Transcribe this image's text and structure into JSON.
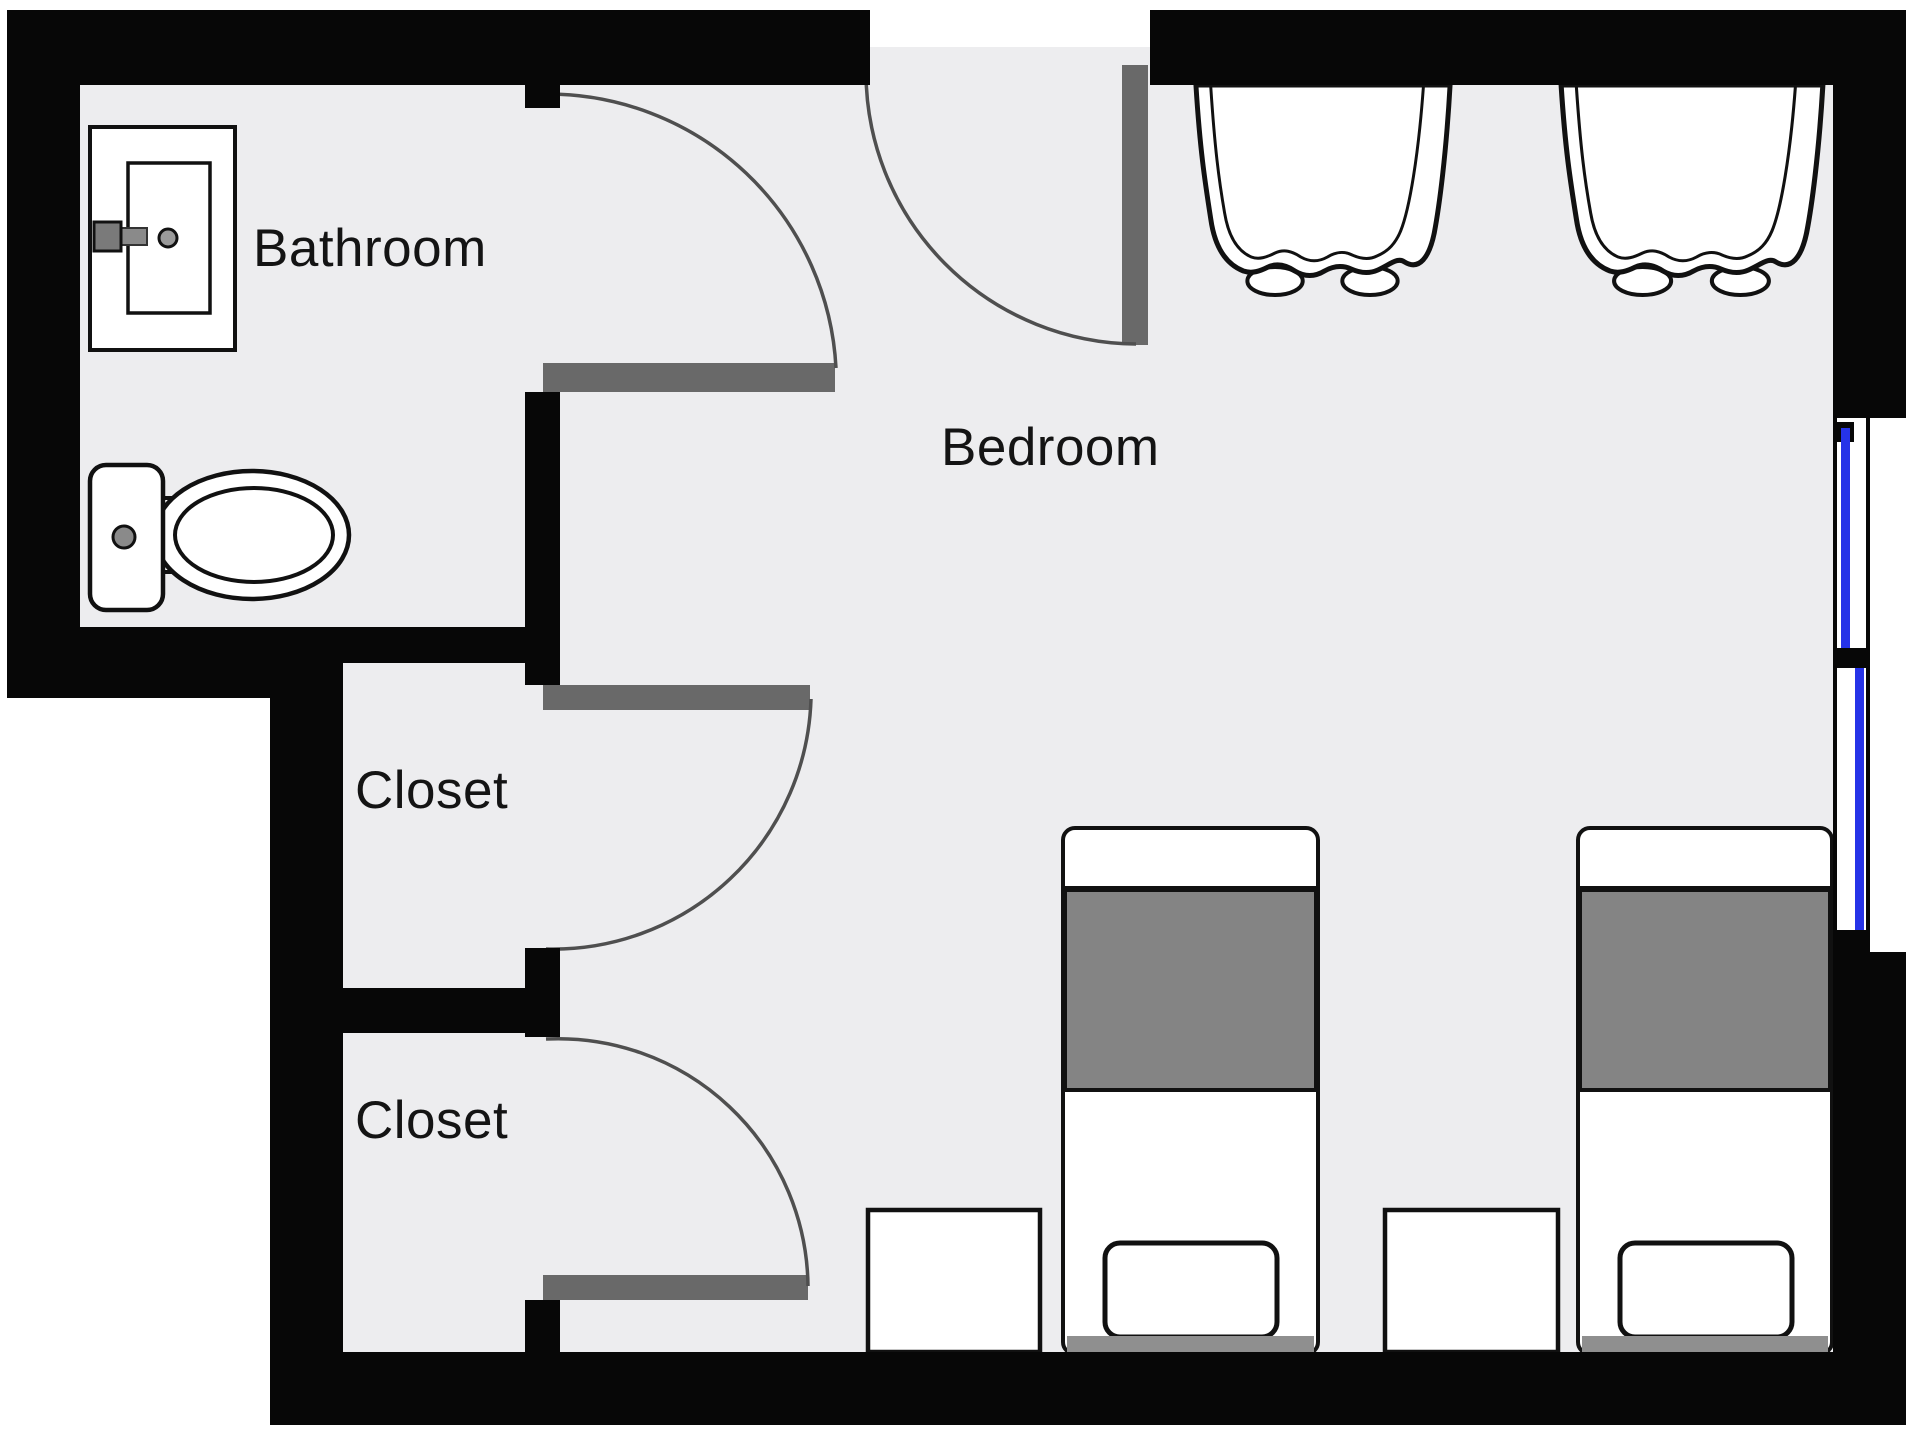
{
  "plan": {
    "rooms": [
      {
        "id": "bathroom",
        "label": "Bathroom"
      },
      {
        "id": "bedroom",
        "label": "Bedroom"
      },
      {
        "id": "closet-upper",
        "label": "Closet"
      },
      {
        "id": "closet-lower",
        "label": "Closet"
      }
    ],
    "fixture_icons": [
      "sink-icon",
      "toilet-icon",
      "curtain-icon",
      "window-icon",
      "door-swing-icon",
      "bed-icon",
      "nightstand-icon"
    ]
  },
  "colors": {
    "background": "#FFFFFF",
    "floor": "#EDEDEF",
    "wall": "#070707",
    "door_leaf": "#696969",
    "door_swing": "#4F4F4F",
    "window_glass": "#2633E8",
    "bed_blanket": "#848484",
    "fixture_outline": "#111111",
    "text": "#141414"
  }
}
